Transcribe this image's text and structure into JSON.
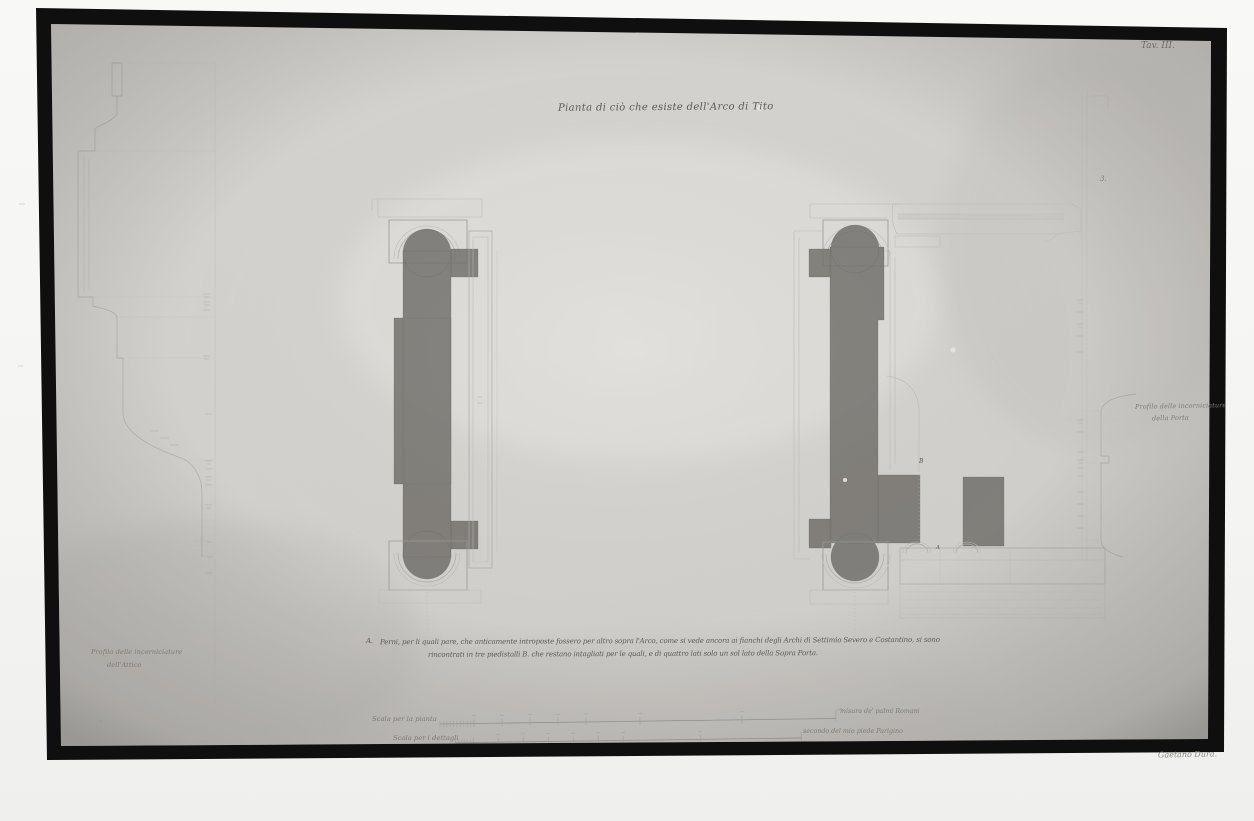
{
  "plate": {
    "tavola": "Tav. III.",
    "title": "Pianta di ciò che esiste dell'Arco di Tito",
    "margin_number": "3.",
    "signature": "Gaetano Dura."
  },
  "captions": {
    "left_profile_line1": "Profilo delle incorniciature",
    "left_profile_line2": "dell'Attico",
    "right_profile_line1": "Profilo delle incorniciature",
    "right_profile_line2": "della Porta"
  },
  "annotations": {
    "letter_b": "B",
    "letter_a": "A"
  },
  "footnote": {
    "marker": "A.",
    "line1": "Perni, per li quali pare, che anticamente introposte fossero per altro sopra l'Arco, come si vede ancora ai fianchi degli Archi di Settimio Severo e Costantino, si sono",
    "line2": "rincontrati in tre piedistalli B. che restano intagliati per le quali, e di quattro lati solo un sol lato della Sopra Porta."
  },
  "scale_bars": {
    "plan": {
      "label": "Scala per la pianta",
      "unit": "misura de' palmi Romani"
    },
    "details": {
      "label": "Scala per i dettagli",
      "unit": "secondo del mio piede Parigino"
    }
  },
  "colors": {
    "paper": "#d4d2ce",
    "photo_frame": "#101010",
    "ink_wash": "#73716c",
    "ink_text": "#5d5a53",
    "faint_line": "#a3a19c"
  }
}
